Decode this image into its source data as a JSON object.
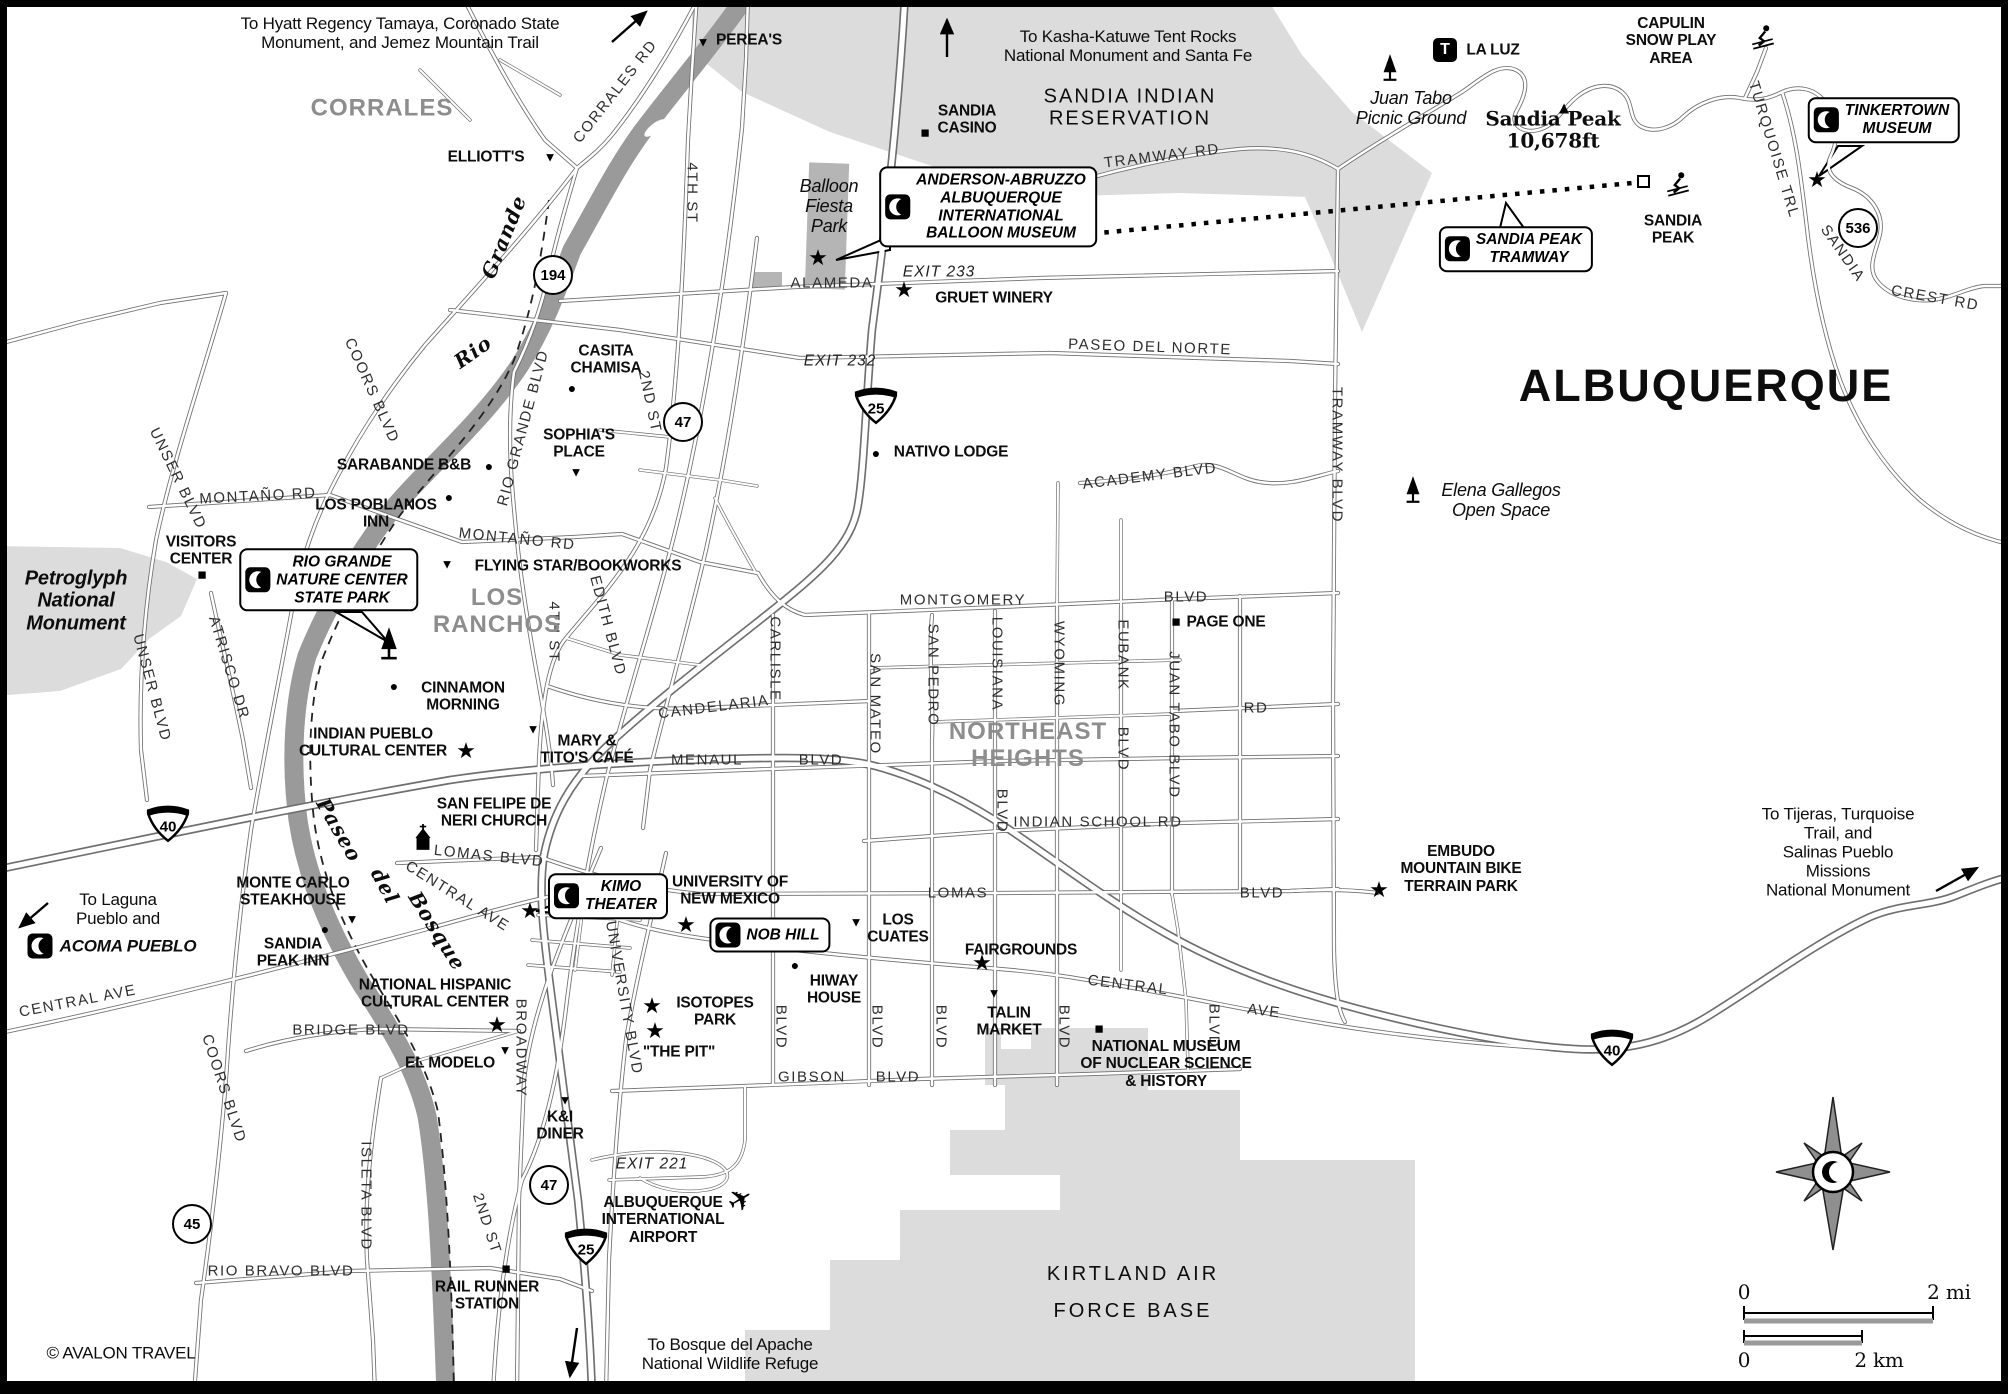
{
  "title": "ALBUQUERQUE",
  "credit": "© AVALON TRAVEL",
  "icons": {
    "star": "★",
    "restaurant": "▼",
    "lodging": "●",
    "sight": "■",
    "peak": "▲",
    "plane": "✈",
    "trailhead": "T"
  },
  "shields": {
    "i25": "25",
    "i40": "40",
    "c45": "45",
    "c47": "47",
    "c194": "194",
    "c536": "536"
  },
  "scale": {
    "mi0": "0",
    "mi2": "2 mi",
    "km0": "0",
    "km2": "2 km"
  },
  "labels": {
    "note_hyatt": "To Hyatt Regency Tamaya, Coronado State\nMonument, and Jemez Mountain Trail",
    "note_kasha": "To Kasha-Katuwe Tent Rocks\nNational Monument and Santa Fe",
    "note_laguna": "To Laguna\nPueblo and",
    "note_tijeras": "To Tijeras, Turquoise Trail, and\nSalinas Pueblo Missions\nNational Monument",
    "note_bosque": "To Bosque del Apache\nNational Wildlife Refuge",
    "corrales": "CORRALES",
    "los_ranchos": "LOS\nRANCHOS",
    "ne_heights": "NORTHEAST\nHEIGHTS",
    "sandia_reservation": "SANDIA INDIAN\nRESERVATION",
    "kirtland": "KIRTLAND AIR\nFORCE BASE",
    "petroglyph": "Petroglyph\nNational\nMonument",
    "balloon_park": "Balloon\nFiesta\nPark",
    "elena": "Elena Gallegos\nOpen Space",
    "juan_tabo_picnic": "Juan Tabo\nPicnic Ground",
    "capulin": "CAPULIN\nSNOW PLAY\nAREA",
    "la_luz": "LA LUZ",
    "sandia_peak_elev": "Sandia Peak\n10,678ft",
    "sandia_peak": "SANDIA\nPEAK",
    "albuquerque_title": "ALBUQUERQUE",
    "avalon": "© AVALON TRAVEL",
    "anderson_callout": "ANDERSON-ABRUZZO\nALBUQUERQUE\nINTERNATIONAL\nBALLOON MUSEUM",
    "rgnc_callout": "RIO GRANDE\nNATURE CENTER\nSTATE PARK",
    "kimo_callout": "KIMO\nTHEATER",
    "nob_hill_callout": "NOB HILL",
    "tramway_callout": "SANDIA PEAK\nTRAMWAY",
    "tinkertown_callout": "TINKERTOWN\nMUSEUM",
    "acoma": "ACOMA PUEBLO",
    "pereas": "PEREA'S",
    "elliotts": "ELLIOTT'S",
    "sandia_casino": "SANDIA\nCASINO",
    "gruet": "GRUET WINERY",
    "casita": "CASITA\nCHAMISA",
    "sophias": "SOPHIA'S\nPLACE",
    "sarabande": "SARABANDE B&B",
    "los_poblanos": "LOS POBLANOS\nINN",
    "flying_star": "FLYING STAR/BOOKWORKS",
    "cinnamon": "CINNAMON\nMORNING",
    "ipcc": "INDIAN PUEBLO\nCULTURAL CENTER",
    "mary_titos": "MARY &\nTITO'S CAFÉ",
    "san_felipe": "SAN FELIPE DE\nNERI CHURCH",
    "nativo": "NATIVO LODGE",
    "page_one": "PAGE ONE",
    "monte_carlo": "MONTE CARLO\nSTEAKHOUSE",
    "sandia_peak_inn": "SANDIA\nPEAK INN",
    "nhcc": "NATIONAL HISPANIC\nCULTURAL CENTER",
    "el_modelo": "EL MODELO",
    "ki_diner": "K&I\nDINER",
    "rail_runner": "RAIL RUNNER\nSTATION",
    "unm": "UNIVERSITY OF\nNEW MEXICO",
    "isotopes": "ISOTOPES\nPARK",
    "the_pit": "\"THE PIT\"",
    "hiway_house": "HIWAY\nHOUSE",
    "los_cuates": "LOS\nCUATES",
    "fairgrounds": "FAIRGROUNDS",
    "talin": "TALIN\nMARKET",
    "airport": "ALBUQUERQUE\nINTERNATIONAL\nAIRPORT",
    "nuclear": "NATIONAL MUSEUM\nOF NUCLEAR SCIENCE\n& HISTORY",
    "embudo": "EMBUDO\nMOUNTAIN BIKE\nTERRAIN PARK",
    "visitors_center": "VISITORS\nCENTER",
    "corrales_rd": "CORRALES RD",
    "fourth_st": "4TH ST",
    "second_st": "2ND ST",
    "edith": "EDITH BLVD",
    "rio_grande_blvd": "RIO GRANDE BLVD",
    "coors": "COORS BLVD",
    "unser": "UNSER BLVD",
    "atrisco": "ATRISCO DR",
    "montano": "MONTAÑO RD",
    "paseo_del_norte": "PASEO   DEL   NORTE",
    "alameda": "ALAMEDA",
    "tramway_rd": "TRAMWAY RD",
    "tramway_blvd": "TRAMWAY BLVD",
    "academy": "ACADEMY  BLVD",
    "montgomery": "MONTGOMERY",
    "blvd": "BLVD",
    "rd": "RD",
    "candelaria": "CANDELARIA",
    "carlisle": "CARLISLE",
    "san_mateo": "SAN  MATEO",
    "san_pedro": "SAN  PEDRO",
    "louisiana": "LOUISIANA",
    "wyoming": "WYOMING",
    "eubank": "EUBANK",
    "juan_tabo_blvd": "JUAN  TABO  BLVD",
    "menaul": "MENAUL",
    "indian_school": "INDIAN SCHOOL RD",
    "lomas": "LOMAS",
    "lomas_blvd": "LOMAS BLVD",
    "central": "CENTRAL",
    "ave": "AVE",
    "central_ave": "CENTRAL  AVE",
    "gibson": "GIBSON",
    "bridge": "BRIDGE BLVD",
    "rio_bravo": "RIO BRAVO BLVD",
    "isleta": "ISLETA  BLVD",
    "university_blvd": "UNIVERSITY BLVD",
    "broadway": "BROADWAY",
    "turquoise": "TURQUOISE TRL",
    "sandia_rot": "SANDIA",
    "crest_rd": "CREST RD",
    "exit233": "EXIT 233",
    "exit232": "EXIT 232",
    "exit221": "EXIT 221",
    "rio": "Rio",
    "grande": "Grande",
    "paseo_b": "Paseo",
    "del_b": "del",
    "bosque_b": "Bosque"
  }
}
